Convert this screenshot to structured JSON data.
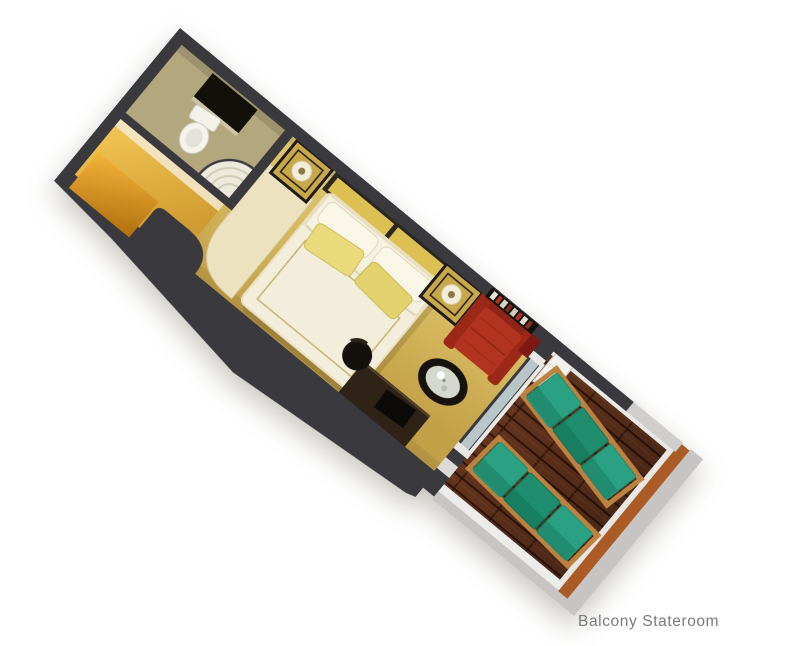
{
  "scene": {
    "title": "Balcony Stateroom",
    "description": "3D cutaway floor-plan rendering of a cruise ship balcony stateroom, rotated diagonally on a white background",
    "rotation_deg": 39.5,
    "areas": [
      {
        "name": "bathroom",
        "features": [
          "toilet",
          "curved-shower",
          "vanity-mirror"
        ]
      },
      {
        "name": "entry",
        "features": [
          "entry-door",
          "curved-wardrobe-wall"
        ]
      },
      {
        "name": "bedroom",
        "features": [
          "queen-bed",
          "white-pillows",
          "yellow-pillows",
          "headboard",
          "nightstand-left",
          "nightstand-right",
          "table-lamps",
          "red-sofa",
          "wall-bookshelf",
          "oval-glass-table",
          "desk",
          "desk-chair",
          "tv",
          "curtain"
        ]
      },
      {
        "name": "balcony",
        "features": [
          "sliding-glass-door",
          "white-cabinet",
          "wood-deck",
          "lounge-chair-1",
          "lounge-chair-2",
          "orange-railing"
        ]
      }
    ]
  },
  "caption": {
    "text": "Balcony Stateroom"
  },
  "colors": {
    "wall": "#3a393d",
    "carpet_light": "#e2c873",
    "carpet_mid": "#d6b95f",
    "carpet_dark": "#c2a047",
    "bath_floor": "#b2a77d",
    "cream_wall": "#ece2c0",
    "entry_gold": "#f2c654",
    "door_amber": "#e8a424",
    "bed_white": "#f3eedb",
    "pillow_yellow": "#e9da7c",
    "headboard_yellow": "#ddc052",
    "nightstand_gold": "#c9a84a",
    "sofa_red": "#b23420",
    "table_ring": "#16130f",
    "glass_blue": "#b9c6c9",
    "deck_wood": "#63341d",
    "deck_gap": "#2e140a",
    "lounger_teal": "#2aa183",
    "lounger_teal_dark": "#1f8e6e",
    "lounger_frame_wood": "#bd8240",
    "balcony_white": "#ececea",
    "balcony_gray": "#c6c5c3",
    "railing_orange": "#ab5c26",
    "caption_gray": "#7b7b7b"
  }
}
